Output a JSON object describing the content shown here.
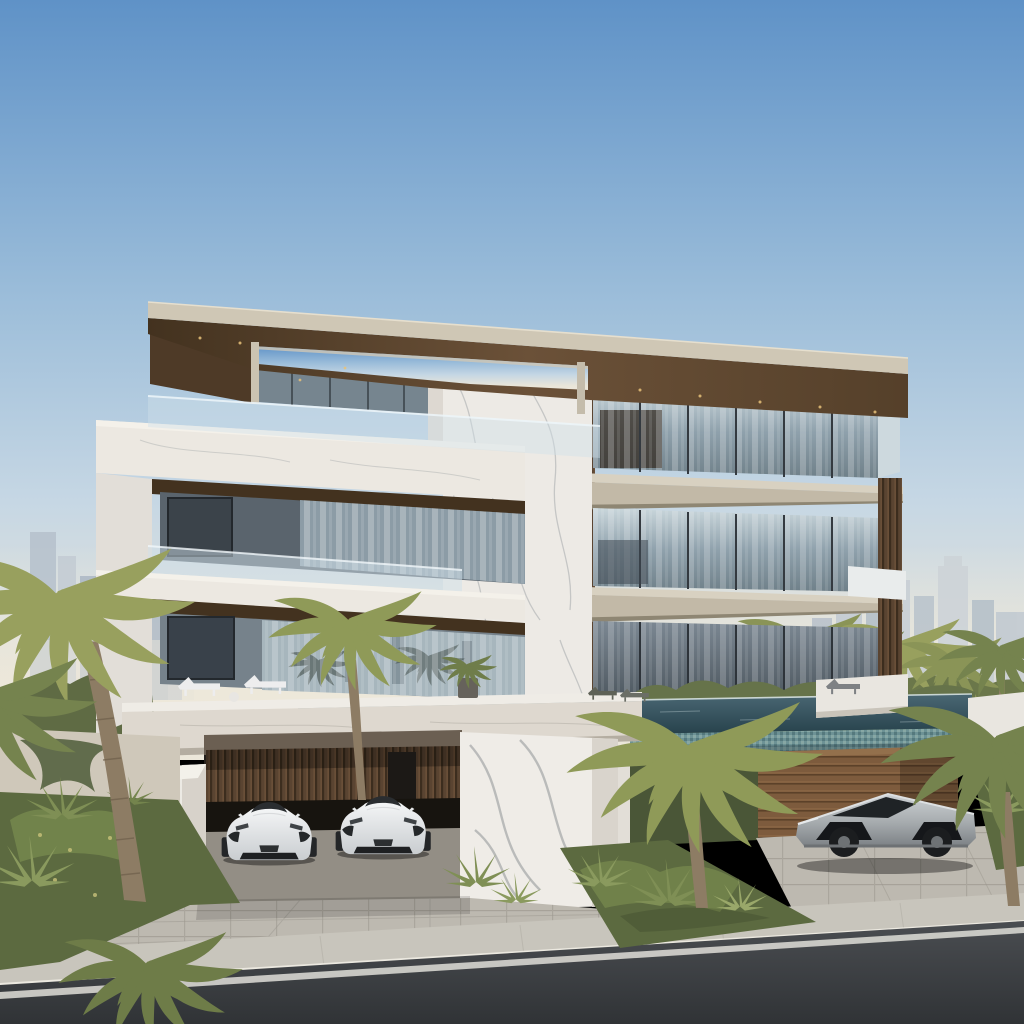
{
  "meta": {
    "kind": "photorealistic-architectural-rendering",
    "description": "Exterior rendering of a modern three-storey luxury villa with a cantilevered wood-soffit roof, white marble and timber-slat facade, glass balustrade terraces, an infinity pool, palm landscaping, two white supercars in an open carport, a silver angular electric pickup beside a timber garage wall, and the Dubai skyline with the Burj Khalifa on the horizon under a clear blue sky."
  },
  "scene": {
    "sky": {
      "condition": "clear daytime sky, hazy at horizon"
    },
    "skyline": {
      "left_landmark": "Burj Khalifa spire",
      "right": "downtown high-rise cluster"
    },
    "villa": {
      "storeys": 3,
      "materials": [
        "white veined marble",
        "dark timber slats",
        "floor-to-ceiling glass",
        "stone slabs"
      ],
      "features": [
        "cantilevered flat roof with skylight cut-out",
        "roof terrace with glass railing",
        "deep marble-framed balconies",
        "reflecting pool on terrace deck",
        "infinity pool with mosaic tile face",
        "open carport"
      ]
    },
    "vehicles": [
      {
        "name": "white supercar",
        "position": "carport, left bay"
      },
      {
        "name": "white supercar",
        "position": "carport, right bay"
      },
      {
        "name": "silver angular electric pickup",
        "position": "right driveway by timber wall"
      }
    ],
    "furniture": [
      {
        "name": "white sun lounger",
        "count": 2
      },
      {
        "name": "grey sun lounger",
        "count": 3
      },
      {
        "name": "round side table",
        "count": 1
      },
      {
        "name": "potted palm",
        "count": 1
      }
    ],
    "vegetation": {
      "palms": "date palms",
      "accents": "agave and ornamental grasses",
      "hedge": "greenery behind infinity pool edge"
    },
    "foreground": {
      "driveway": "light stone pavers",
      "sidewalk": "paved walk",
      "road": "dark asphalt with white edge line"
    }
  },
  "palette": {
    "sky_top": "#5f92c7",
    "sky_mid": "#9abcd9",
    "sky_low": "#cddcе7",
    "sky_horizon": "#e9e5d9",
    "haze": "#efe9db",
    "skyline_tower": "#bcc6d0",
    "burj": "#c9d2da",
    "roof_fascia": "#cfc7b5",
    "roof_wood": "#6b5138",
    "roof_wood_dark": "#43321f",
    "marble": "#edeae5",
    "marble_shade": "#d9d4cd",
    "marble_vein": "#9fa3a6",
    "wood_slat": "#5a4431",
    "wood_plank": "#7d5b3d",
    "slab": "#d8d1c1",
    "slab_under": "#c2b9a7",
    "glass_dark_interior": "#342b22",
    "railing_glass": "#cfe0ea",
    "pool_water": "#31505c",
    "pool_tile": "#6d9295",
    "hedge": "#66734a",
    "palm_light": "#98a05e",
    "palm_dark": "#75834e",
    "palm_trunk": "#8d7c64",
    "garden": "#5c6a40",
    "agave": "#7f8f55",
    "stucco_wall": "#cfc8ba",
    "driveway": "#bdb9b0",
    "sidewalk": "#c8c5bc",
    "road": "#45484c",
    "road_line": "#dbd9d4",
    "car_white": "#f2f3f4",
    "car_glass": "#2a2d30",
    "cyber_body": "#b4b8bb",
    "cyber_glass": "#1f2326",
    "lounger_white": "#ededee",
    "lounger_grey": "#7e8184",
    "plinth_white": "#e9e6e0"
  }
}
